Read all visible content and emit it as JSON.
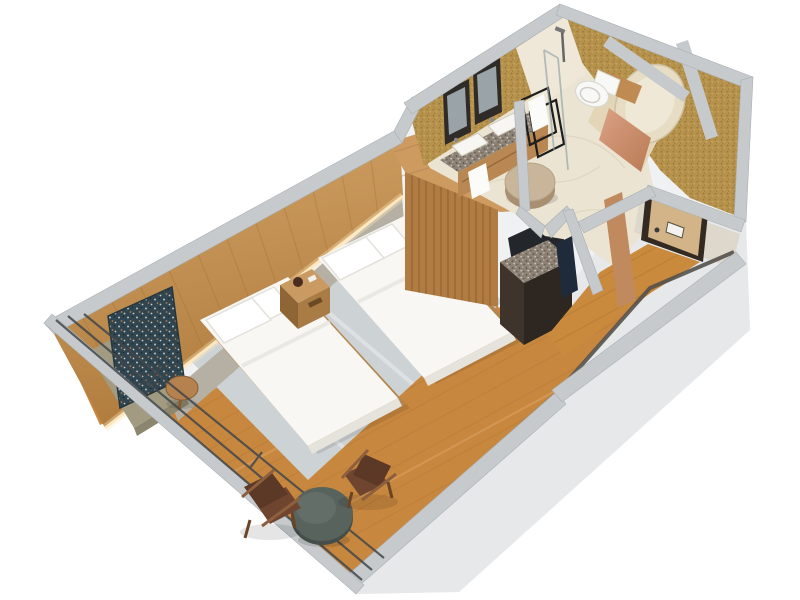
{
  "scene": {
    "title": "Isometric 3D cutaway floor plan of a twin hotel guest room",
    "view": "3d-isometric-cutaway",
    "width_px": 800,
    "height_px": 600
  },
  "rooms": [
    {
      "id": "bedroom",
      "label": "Bedroom with twin beds",
      "floor": "wood plank"
    },
    {
      "id": "sitting-area",
      "label": "Sitting area at window wall",
      "floor": "wood plank"
    },
    {
      "id": "bathroom",
      "label": "Bathroom with double vanity",
      "floor": "cream marble"
    },
    {
      "id": "tub-niche",
      "label": "Bathtub niche",
      "walls": "gold seagrass wallpaper"
    },
    {
      "id": "corner-closet",
      "label": "Corner closet room",
      "walls": "gold seagrass wallpaper"
    },
    {
      "id": "entry",
      "label": "Entry hall with door",
      "floor": "wood plank"
    }
  ],
  "furniture": [
    {
      "room": "bedroom",
      "item": "twin bed 1 with white duvet and two pillows"
    },
    {
      "room": "bedroom",
      "item": "twin bed 2 with white duvet and two pillows"
    },
    {
      "room": "bedroom",
      "item": "wood nightstand with dark clock"
    },
    {
      "room": "bedroom",
      "item": "wood slat headboard wall with LED cove light"
    },
    {
      "room": "bedroom",
      "item": "abstract wall artwork"
    },
    {
      "room": "bedroom",
      "item": "olive bench / console at window end"
    },
    {
      "room": "bedroom",
      "item": "round wood side table"
    },
    {
      "room": "bedroom",
      "item": "gray area rug"
    },
    {
      "room": "bedroom",
      "item": "wood slat wardrobe with top shelf"
    },
    {
      "room": "bedroom",
      "item": "dark minibar / luggage cabinet with stone top"
    },
    {
      "room": "sitting-area",
      "item": "two brown leather sling chairs"
    },
    {
      "room": "sitting-area",
      "item": "round dark coffee table"
    },
    {
      "room": "sitting-area",
      "item": "floor-to-ceiling window wall with dark mullions"
    },
    {
      "room": "bathroom",
      "item": "double-sink granite vanity"
    },
    {
      "room": "bathroom",
      "item": "two black framed mirrors"
    },
    {
      "room": "bathroom",
      "item": "black towel ladder with white towels"
    },
    {
      "room": "bathroom",
      "item": "glass walk-in shower with chrome fixture"
    },
    {
      "room": "bathroom",
      "item": "white toilet with wood ledge"
    },
    {
      "room": "bathroom",
      "item": "round tan vanity stool"
    },
    {
      "room": "tub-niche",
      "item": "freestanding cream bathtub"
    },
    {
      "room": "tub-niche",
      "item": "copper accent panel"
    },
    {
      "room": "entry",
      "item": "wood entry door with dark frame, plaque and handle"
    }
  ],
  "colors": {
    "background": "#ffffff",
    "wallTop": "#c6cacd",
    "wallTopEdge": "#aab0b4",
    "exterior": "#f0f1f3",
    "exteriorShade": "#e6e8ea",
    "woodFloor": "#c8873f",
    "plankDark": "#a8702f",
    "plankLight": "#e2b077",
    "rug": "#cdd2d4",
    "rugStreak": "#ffffff",
    "headboardWood": "#c99a5e",
    "headboardGrain": "#9a6a30",
    "headboardPanel": "#b5b0a3",
    "ledGlow": "#ffe9c0",
    "slatWood": "#b07c44",
    "slatLine": "#7e5024",
    "slabWood": "#cd9a60",
    "artBase": "#30454f",
    "oliveBench": "#a29b81",
    "sideTable": "#b5814e",
    "bedWhite": "#f8f7f3",
    "bedShade": "#e6e3dc",
    "pillow": "#ffffff",
    "platform": "#b5854e",
    "nightstand": "#c99a62",
    "nightstandFront": "#a97c46",
    "nightstandSide": "#8f6536",
    "chairLeather": "#6f4530",
    "chairBack": "#5c3826",
    "chairFrame": "#8d5f3c",
    "coffeeTable": "#59635d",
    "coffeeTableRim": "#454e48",
    "marbleFloor": "#ece4d2",
    "marbleVein": "#d9cdb4",
    "showerWall": "#efe8d8",
    "goldWall": "#b6924d",
    "goldDot": "#8f6f30",
    "granite": "#8d8276",
    "vanityWood": "#b88752",
    "sinkWhite": "#f7f6f3",
    "mirrorFrame": "#2e2b28",
    "mirrorGlass": "#9aa3a8",
    "towelWhite": "#fbfbf9",
    "rackBlack": "#1e1e1e",
    "glassLine": "#8fa3a8",
    "toiletWhite": "#f8f8f6",
    "woodLedge": "#c08b52",
    "stoolTan": "#c9b599",
    "stoolShade": "#a98f72",
    "tubCream": "#e7dcc4",
    "tubInner": "#f0e8d6",
    "copperPanel": "#c98d6b",
    "doorTan": "#d3b488",
    "doorFrame": "#342a22",
    "doorPlaque": "#f4f2ee",
    "entryWood": "#c98a3e",
    "threshold": "#54504b",
    "minibarTop": "#7a7265",
    "minibarBody": "#3f342c",
    "minibarSide": "#2e2620",
    "minibarOpening": "#23272b",
    "navyBox": "#1f2a3a",
    "mullion": "#42474b"
  }
}
